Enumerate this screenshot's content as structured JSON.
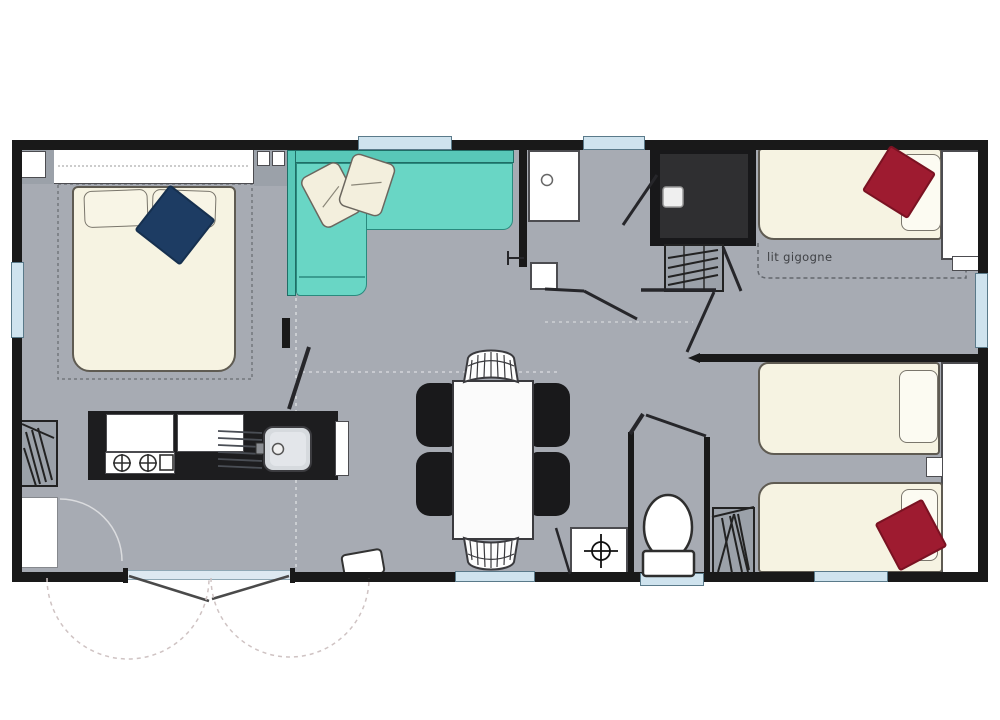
{
  "floorplan": {
    "type": "mobile-home-floor-plan",
    "labels": {
      "trundle_bed": "lit gigogne"
    },
    "colors": {
      "floor": "#a7abb3",
      "wall": "#191919",
      "sofa_teal": "#69d6c5",
      "bed_cream": "#f6f3e2",
      "blanket_navy": "#1d3c63",
      "blanket_red": "#9e1b30",
      "window_blue": "#cfe3ee",
      "shower_dark": "#2f2f31",
      "cabinet_gray": "#9ba1a9",
      "white": "#ffffff"
    },
    "elements": [
      "double-bed",
      "headboard-shelf",
      "corner-sofa",
      "sofa-pillows",
      "navy-blanket",
      "washbasin",
      "shower",
      "wardrobes",
      "single-bed-trundle",
      "twin-single-beds",
      "red-blankets",
      "dining-table",
      "four-chairs",
      "two-wicker-stools",
      "kitchen-counter",
      "gas-hob",
      "kitchen-sink",
      "fridge-cabinet",
      "toilet",
      "water-heater",
      "entrance-double-door",
      "windows"
    ]
  }
}
